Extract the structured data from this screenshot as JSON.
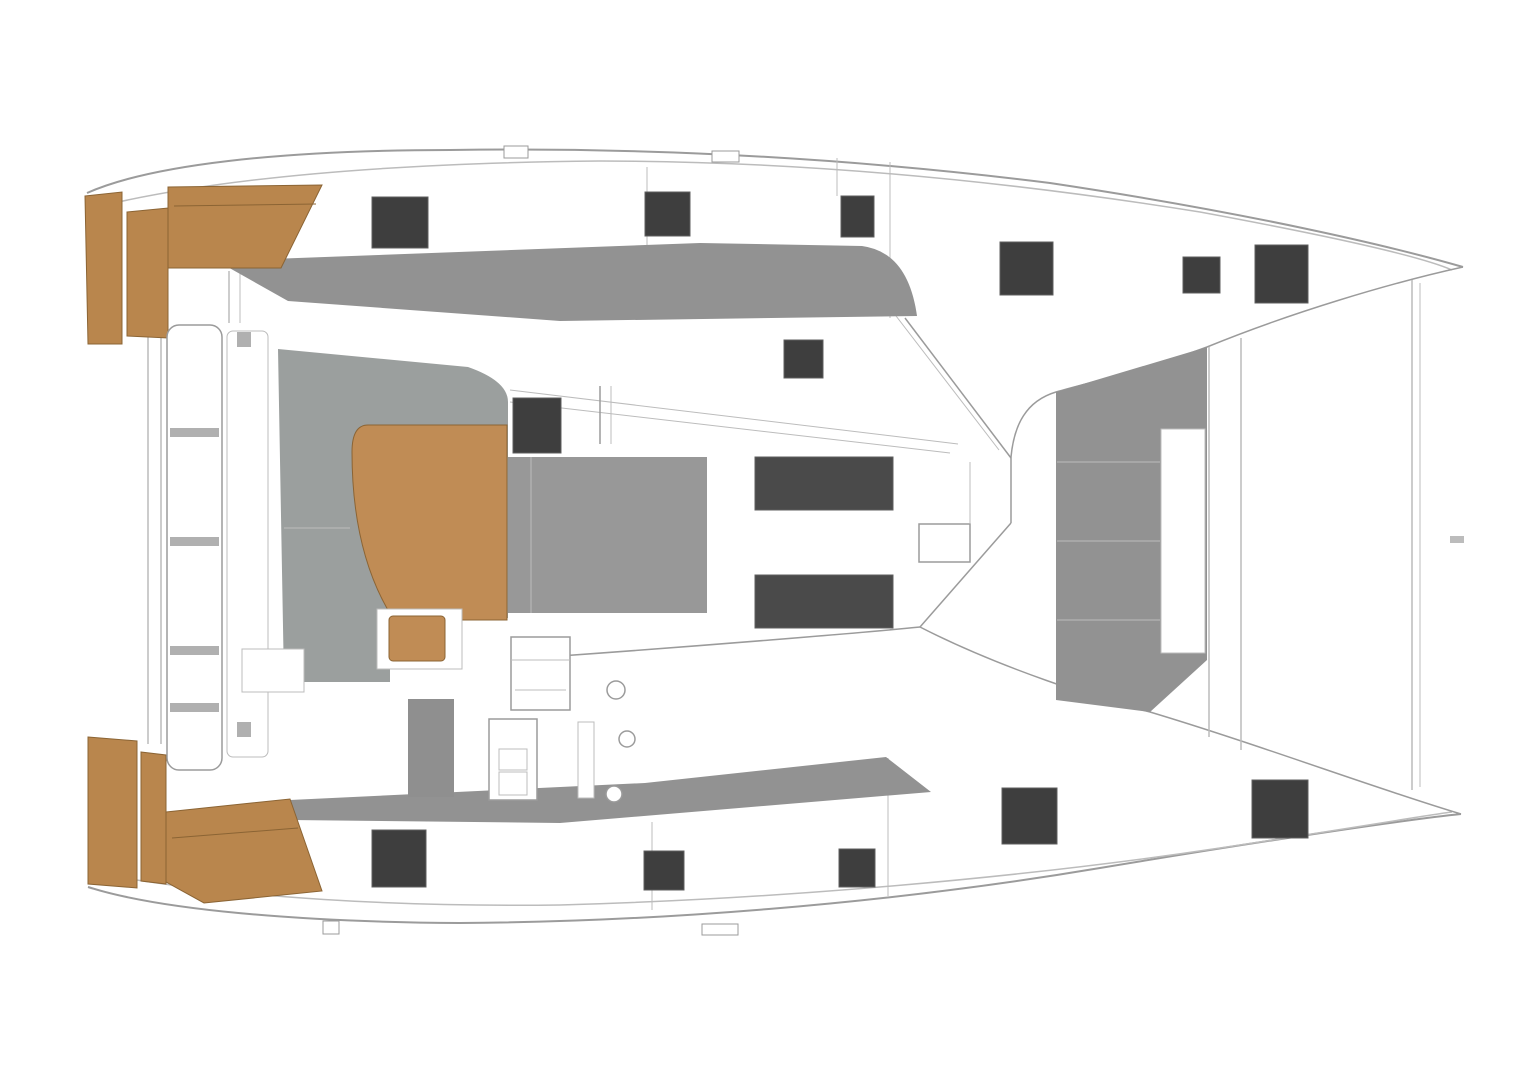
{
  "canvas": {
    "width": 1514,
    "height": 1080
  },
  "colors": {
    "bg": "#ffffff",
    "white": "#ffffff",
    "line": "#9b9b9b",
    "lineLight": "#bcbcbc",
    "deckGray": "#929292",
    "cockpitGray": "#9b9f9e",
    "sunpadGray": "#989898",
    "seatGray": "#8f8f8f",
    "dividerGray": "#b0b0b0",
    "hatchDark": "#3e3e3e",
    "hatchEdge": "#5f5f5f",
    "windowDark": "#4a4a4a",
    "wood": "#b9864d",
    "tableWood": "#c08c55",
    "woodEdge": "#8b6434"
  },
  "shapes": [
    {
      "name": "port-hull-outer-sheer-line",
      "type": "path",
      "d": "M87,193 C150,165 280,150 450,150 C650,147 850,158 1050,183 C1250,213 1390,246 1463,267",
      "fill": "none",
      "stroke": "line",
      "sw": 2
    },
    {
      "name": "port-hull-inner-sheer-line",
      "type": "path",
      "d": "M105,205 C230,176 400,163 600,161 C800,161 1000,180 1200,212 C1330,236 1420,256 1452,270",
      "fill": "none",
      "stroke": "lineLight",
      "sw": 1.5
    },
    {
      "name": "starboard-hull-outer-sheer-line",
      "type": "path",
      "d": "M88,887 C160,910 300,922 460,923 C650,922 880,905 1100,868 C1280,838 1420,818 1461,814",
      "fill": "none",
      "stroke": "line",
      "sw": 2
    },
    {
      "name": "starboard-hull-inner-sheer-line",
      "type": "path",
      "d": "M112,876 C240,898 400,907 560,905 C780,899 1020,878 1220,848 C1360,827 1440,813 1452,812",
      "fill": "none",
      "stroke": "lineLight",
      "sw": 1.5
    },
    {
      "name": "port-hull-inboard-edge-line",
      "type": "path",
      "d": "M1463,267 C1390,283 1290,313 1207,347 C1140,372 1090,382 1056,392 C1026,401 1014,425 1011,457",
      "fill": "none",
      "stroke": "line",
      "sw": 1.5
    },
    {
      "name": "starboard-walkway-edge-line",
      "type": "path",
      "d": "M920,627 C1000,668 1100,700 1150,712 C1260,745 1380,790 1461,814",
      "fill": "none",
      "stroke": "line",
      "sw": 1.5
    },
    {
      "name": "stern-center-line-left",
      "type": "path",
      "d": "M148,333 L148,744",
      "fill": "none",
      "stroke": "lineLight",
      "sw": 1.5
    },
    {
      "name": "stern-center-line-right",
      "type": "path",
      "d": "M161,333 L161,744",
      "fill": "none",
      "stroke": "lineLight",
      "sw": 1.5
    },
    {
      "name": "port-deck-frame-line-1",
      "type": "path",
      "d": "M647,167 L647,245",
      "fill": "none",
      "stroke": "lineLight",
      "sw": 1
    },
    {
      "name": "port-deck-frame-line-2",
      "type": "path",
      "d": "M890,162 L890,318",
      "fill": "none",
      "stroke": "lineLight",
      "sw": 1
    },
    {
      "name": "port-deck-frame-line-3",
      "type": "path",
      "d": "M837,158 L837,196",
      "fill": "none",
      "stroke": "lineLight",
      "sw": 1
    },
    {
      "name": "starboard-deck-frame-line-1",
      "type": "path",
      "d": "M652,822 L652,910",
      "fill": "none",
      "stroke": "lineLight",
      "sw": 1
    },
    {
      "name": "starboard-deck-frame-line-2",
      "type": "path",
      "d": "M888,758 L888,896",
      "fill": "none",
      "stroke": "lineLight",
      "sw": 1
    },
    {
      "name": "foredeck-beam-line-1",
      "type": "path",
      "d": "M1209,347 L1209,737",
      "fill": "none",
      "stroke": "lineLight",
      "sw": 1.5
    },
    {
      "name": "foredeck-beam-line-2",
      "type": "path",
      "d": "M1241,338 L1241,750",
      "fill": "none",
      "stroke": "lineLight",
      "sw": 1.5
    },
    {
      "name": "bow-bridle-line-1",
      "type": "path",
      "d": "M1412,280 L1412,790",
      "fill": "none",
      "stroke": "lineLight",
      "sw": 1.5
    },
    {
      "name": "bow-bridle-line-2",
      "type": "path",
      "d": "M1420,283 L1420,787",
      "fill": "none",
      "stroke": "lineLight",
      "sw": 1
    },
    {
      "name": "windshield-top-edge-line",
      "type": "path",
      "d": "M905,318 L1011,458",
      "fill": "none",
      "stroke": "line",
      "sw": 1.5
    },
    {
      "name": "windshield-top-edge-line-2",
      "type": "path",
      "d": "M893,312 L999,450",
      "fill": "none",
      "stroke": "lineLight",
      "sw": 1
    },
    {
      "name": "windshield-mullion-line",
      "type": "path",
      "d": "M1011,457 L1011,523",
      "fill": "none",
      "stroke": "line",
      "sw": 1.5
    },
    {
      "name": "windshield-mullion-line-2",
      "type": "path",
      "d": "M970,462 L970,523",
      "fill": "none",
      "stroke": "lineLight",
      "sw": 1
    },
    {
      "name": "windshield-bottom-edge-line",
      "type": "path",
      "d": "M1011,523 L920,627",
      "fill": "none",
      "stroke": "line",
      "sw": 1.5
    },
    {
      "name": "coachroof-bottom-edge-line",
      "type": "path",
      "d": "M560,656 C700,646 860,633 920,627",
      "fill": "none",
      "stroke": "line",
      "sw": 1.5
    },
    {
      "name": "coachroof-diagonal-line-1",
      "type": "path",
      "d": "M510,390 L958,444",
      "fill": "none",
      "stroke": "lineLight",
      "sw": 1
    },
    {
      "name": "coachroof-diagonal-line-2",
      "type": "path",
      "d": "M510,402 L950,453",
      "fill": "none",
      "stroke": "lineLight",
      "sw": 1
    },
    {
      "name": "mast-support-line-1",
      "type": "path",
      "d": "M600,386 L600,444",
      "fill": "none",
      "stroke": "line",
      "sw": 1.5
    },
    {
      "name": "mast-support-line-2",
      "type": "path",
      "d": "M611,386 L611,444",
      "fill": "none",
      "stroke": "lineLight",
      "sw": 1
    },
    {
      "name": "port-transom-step-line-1",
      "type": "path",
      "d": "M229,271 L229,323",
      "fill": "none",
      "stroke": "lineLight",
      "sw": 1.5
    },
    {
      "name": "port-transom-step-line-2",
      "type": "path",
      "d": "M240,272 L240,323",
      "fill": "none",
      "stroke": "lineLight",
      "sw": 1
    },
    {
      "name": "side-deck-nonskid-port",
      "type": "path",
      "d": "M217,261 L700,243 L862,246 Q908,252 917,316 L560,321 L288,301 Z",
      "fill": "deckGray",
      "stroke": "none",
      "sw": 0
    },
    {
      "name": "side-deck-nonskid-starboard",
      "type": "path",
      "d": "M290,800 L645,783 L886,757 L931,792 L560,823 L290,820 Z",
      "fill": "deckGray",
      "stroke": "none",
      "sw": 0
    },
    {
      "name": "cockpit-floor-area",
      "type": "path",
      "d": "M278,349 L468,367 Q508,381 508,402 L508,618 L447,618 L447,662 L390,662 L390,682 L284,682 Z",
      "fill": "cockpitGray",
      "stroke": "none",
      "sw": 0
    },
    {
      "name": "coachroof-sunpad-area",
      "type": "rect",
      "x": 508,
      "y": 457,
      "w": 199,
      "h": 156,
      "fill": "sunpadGray",
      "stroke": "none",
      "sw": 0
    },
    {
      "name": "sunpad-divider-line",
      "type": "path",
      "d": "M531,457 L531,613",
      "fill": "none",
      "stroke": "lineLight",
      "sw": 1
    },
    {
      "name": "cockpit-seat-edge-line",
      "type": "path",
      "d": "M284,528 L350,528",
      "fill": "none",
      "stroke": "lineLight",
      "sw": 1
    },
    {
      "name": "foredeck-lounge-panel",
      "type": "path",
      "d": "M1056,392 L1207,347 L1207,660 L1150,712 L1056,700 Z",
      "fill": "deckGray",
      "stroke": "none",
      "sw": 0
    },
    {
      "name": "foredeck-panel-seam-line-1",
      "type": "path",
      "d": "M1057,462 L1160,462",
      "fill": "none",
      "stroke": "lineLight",
      "sw": 1
    },
    {
      "name": "foredeck-panel-seam-line-2",
      "type": "path",
      "d": "M1057,541 L1160,541",
      "fill": "none",
      "stroke": "lineLight",
      "sw": 1
    },
    {
      "name": "foredeck-panel-seam-line-3",
      "type": "path",
      "d": "M1057,620 L1160,620",
      "fill": "none",
      "stroke": "lineLight",
      "sw": 1
    },
    {
      "name": "foredeck-panel-inset",
      "type": "rect",
      "x": 1161,
      "y": 429,
      "w": 44,
      "h": 224,
      "fill": "white",
      "stroke": "lineLight",
      "sw": 1
    },
    {
      "name": "helm-seat",
      "type": "rect",
      "x": 408,
      "y": 699,
      "w": 46,
      "h": 98,
      "fill": "seatGray",
      "stroke": "none",
      "sw": 0
    },
    {
      "name": "port-swim-platform-step",
      "type": "path",
      "d": "M85,196 L122,192 L122,344 L88,344 Z",
      "fill": "wood",
      "stroke": "woodEdge",
      "sw": 1
    },
    {
      "name": "port-swim-platform-step-2",
      "type": "path",
      "d": "M127,212 L168,208 L168,338 L127,336 Z",
      "fill": "wood",
      "stroke": "woodEdge",
      "sw": 1
    },
    {
      "name": "port-swim-platform-deck",
      "type": "path",
      "d": "M168,187 L322,185 L281,268 L168,268 Z",
      "fill": "wood",
      "stroke": "woodEdge",
      "sw": 1
    },
    {
      "name": "port-platform-plank-line",
      "type": "path",
      "d": "M174,206 L316,204",
      "fill": "none",
      "stroke": "woodEdge",
      "sw": 1
    },
    {
      "name": "starboard-swim-platform-step",
      "type": "path",
      "d": "M88,737 L137,741 L137,888 L88,884 Z",
      "fill": "wood",
      "stroke": "woodEdge",
      "sw": 1
    },
    {
      "name": "starboard-swim-platform-step-2",
      "type": "path",
      "d": "M141,752 L166,755 L166,884 L141,881 Z",
      "fill": "wood",
      "stroke": "woodEdge",
      "sw": 1
    },
    {
      "name": "starboard-swim-platform-deck",
      "type": "path",
      "d": "M166,812 L290,799 L322,891 L204,903 L166,882 Z",
      "fill": "wood",
      "stroke": "woodEdge",
      "sw": 1
    },
    {
      "name": "starboard-platform-plank-line",
      "type": "path",
      "d": "M172,838 L298,828",
      "fill": "none",
      "stroke": "woodEdge",
      "sw": 1
    },
    {
      "name": "cockpit-table",
      "type": "path",
      "d": "M368,425 L507,425 L507,620 L394,620 Q352,555 352,452 Q352,425 368,425 Z",
      "fill": "tableWood",
      "stroke": "woodEdge",
      "sw": 1
    },
    {
      "name": "aft-cockpit-bench",
      "type": "rect",
      "x": 167,
      "y": 325,
      "w": 55,
      "h": 445,
      "rx": 12,
      "fill": "white",
      "stroke": "line",
      "sw": 1.5
    },
    {
      "name": "aft-cockpit-bench-backrest",
      "type": "rect",
      "x": 227,
      "y": 331,
      "w": 41,
      "h": 426,
      "rx": 6,
      "fill": "white",
      "stroke": "lineLight",
      "sw": 1
    },
    {
      "name": "bench-divider-1",
      "type": "rect",
      "x": 170,
      "y": 428,
      "w": 49,
      "h": 9,
      "fill": "dividerGray",
      "stroke": "none",
      "sw": 0
    },
    {
      "name": "bench-divider-2",
      "type": "rect",
      "x": 170,
      "y": 537,
      "w": 49,
      "h": 9,
      "fill": "dividerGray",
      "stroke": "none",
      "sw": 0
    },
    {
      "name": "bench-divider-3",
      "type": "rect",
      "x": 170,
      "y": 646,
      "w": 49,
      "h": 9,
      "fill": "dividerGray",
      "stroke": "none",
      "sw": 0
    },
    {
      "name": "bench-divider-4",
      "type": "rect",
      "x": 170,
      "y": 703,
      "w": 49,
      "h": 9,
      "fill": "dividerGray",
      "stroke": "none",
      "sw": 0
    },
    {
      "name": "backrest-fitting-top",
      "type": "rect",
      "x": 237,
      "y": 332,
      "w": 14,
      "h": 15,
      "fill": "dividerGray",
      "stroke": "none",
      "sw": 0
    },
    {
      "name": "backrest-fitting-bottom",
      "type": "rect",
      "x": 237,
      "y": 722,
      "w": 14,
      "h": 15,
      "fill": "dividerGray",
      "stroke": "none",
      "sw": 0
    },
    {
      "name": "cockpit-storage-box",
      "type": "rect",
      "x": 242,
      "y": 649,
      "w": 62,
      "h": 43,
      "fill": "white",
      "stroke": "lineLight",
      "sw": 1
    },
    {
      "name": "helm-stool-frame",
      "type": "rect",
      "x": 377,
      "y": 609,
      "w": 85,
      "h": 60,
      "fill": "white",
      "stroke": "lineLight",
      "sw": 1
    },
    {
      "name": "helm-stool-cushion",
      "type": "rect",
      "x": 389,
      "y": 616,
      "w": 56,
      "h": 45,
      "rx": 4,
      "fill": "tableWood",
      "stroke": "woodEdge",
      "sw": 1
    },
    {
      "name": "helm-module",
      "type": "rect",
      "x": 511,
      "y": 637,
      "w": 59,
      "h": 73,
      "fill": "white",
      "stroke": "line",
      "sw": 1.5
    },
    {
      "name": "helm-module-shelf-line",
      "type": "path",
      "d": "M511,660 L570,660",
      "fill": "none",
      "stroke": "lineLight",
      "sw": 1
    },
    {
      "name": "helm-module-shelf-line-2",
      "type": "path",
      "d": "M515,690 L566,690",
      "fill": "none",
      "stroke": "lineLight",
      "sw": 1
    },
    {
      "name": "helm-console",
      "type": "rect",
      "x": 489,
      "y": 719,
      "w": 48,
      "h": 81,
      "fill": "white",
      "stroke": "line",
      "sw": 1.5
    },
    {
      "name": "helm-console-panel-1",
      "type": "rect",
      "x": 499,
      "y": 749,
      "w": 28,
      "h": 21,
      "fill": "none",
      "stroke": "lineLight",
      "sw": 1
    },
    {
      "name": "helm-console-panel-2",
      "type": "rect",
      "x": 499,
      "y": 772,
      "w": 28,
      "h": 23,
      "fill": "none",
      "stroke": "lineLight",
      "sw": 1
    },
    {
      "name": "helm-side-locker",
      "type": "rect",
      "x": 578,
      "y": 722,
      "w": 16,
      "h": 76,
      "fill": "white",
      "stroke": "lineLight",
      "sw": 1
    },
    {
      "name": "winch-1",
      "type": "circle",
      "cx": 616,
      "cy": 690,
      "r": 9,
      "fill": "white",
      "stroke": "line",
      "sw": 1.5
    },
    {
      "name": "winch-2",
      "type": "circle",
      "cx": 627,
      "cy": 739,
      "r": 8,
      "fill": "white",
      "stroke": "line",
      "sw": 1.5
    },
    {
      "name": "winch-3",
      "type": "circle",
      "cx": 614,
      "cy": 794,
      "r": 8,
      "fill": "white",
      "stroke": "line",
      "sw": 1.5
    },
    {
      "name": "walkway-locker-box",
      "type": "rect",
      "x": 919,
      "y": 524,
      "w": 51,
      "h": 38,
      "fill": "white",
      "stroke": "line",
      "sw": 1.5
    },
    {
      "name": "port-rail-fitting",
      "type": "rect",
      "x": 504,
      "y": 146,
      "w": 24,
      "h": 12,
      "fill": "white",
      "stroke": "line",
      "sw": 1
    },
    {
      "name": "port-rail-fitting-2",
      "type": "rect",
      "x": 712,
      "y": 151,
      "w": 27,
      "h": 11,
      "fill": "white",
      "stroke": "line",
      "sw": 1
    },
    {
      "name": "starboard-rail-fitting",
      "type": "rect",
      "x": 702,
      "y": 924,
      "w": 36,
      "h": 11,
      "fill": "white",
      "stroke": "line",
      "sw": 1
    },
    {
      "name": "starboard-rail-fitting-2",
      "type": "rect",
      "x": 323,
      "y": 921,
      "w": 16,
      "h": 13,
      "fill": "white",
      "stroke": "line",
      "sw": 1
    },
    {
      "name": "centerline-tick",
      "type": "rect",
      "x": 1450,
      "y": 536,
      "w": 14,
      "h": 7,
      "fill": "lineLight",
      "stroke": "none",
      "sw": 0
    },
    {
      "name": "deck-hatch-port-aft",
      "type": "rect",
      "x": 372,
      "y": 197,
      "w": 56,
      "h": 51,
      "fill": "hatchDark",
      "stroke": "hatchEdge",
      "sw": 1
    },
    {
      "name": "deck-hatch-port-mid-1",
      "type": "rect",
      "x": 645,
      "y": 192,
      "w": 45,
      "h": 44,
      "fill": "hatchDark",
      "stroke": "hatchEdge",
      "sw": 1
    },
    {
      "name": "deck-hatch-port-mid-2",
      "type": "rect",
      "x": 841,
      "y": 196,
      "w": 33,
      "h": 41,
      "fill": "hatchDark",
      "stroke": "hatchEdge",
      "sw": 1
    },
    {
      "name": "deck-hatch-port-fwd-1",
      "type": "rect",
      "x": 1000,
      "y": 242,
      "w": 53,
      "h": 53,
      "fill": "hatchDark",
      "stroke": "hatchEdge",
      "sw": 1
    },
    {
      "name": "deck-hatch-port-fwd-small",
      "type": "rect",
      "x": 1183,
      "y": 257,
      "w": 37,
      "h": 36,
      "fill": "hatchDark",
      "stroke": "hatchEdge",
      "sw": 1
    },
    {
      "name": "deck-hatch-port-bow",
      "type": "rect",
      "x": 1255,
      "y": 245,
      "w": 53,
      "h": 58,
      "fill": "hatchDark",
      "stroke": "hatchEdge",
      "sw": 1
    },
    {
      "name": "coachroof-hatch-small",
      "type": "rect",
      "x": 784,
      "y": 340,
      "w": 39,
      "h": 38,
      "fill": "hatchDark",
      "stroke": "hatchEdge",
      "sw": 1
    },
    {
      "name": "coachroof-hatch-mast",
      "type": "rect",
      "x": 513,
      "y": 398,
      "w": 48,
      "h": 55,
      "fill": "hatchDark",
      "stroke": "hatchEdge",
      "sw": 1
    },
    {
      "name": "coachroof-window-1",
      "type": "rect",
      "x": 755,
      "y": 457,
      "w": 138,
      "h": 53,
      "fill": "windowDark",
      "stroke": "hatchEdge",
      "sw": 1
    },
    {
      "name": "coachroof-window-2",
      "type": "rect",
      "x": 755,
      "y": 575,
      "w": 138,
      "h": 53,
      "fill": "windowDark",
      "stroke": "hatchEdge",
      "sw": 1
    },
    {
      "name": "deck-hatch-stbd-aft",
      "type": "rect",
      "x": 372,
      "y": 830,
      "w": 54,
      "h": 57,
      "fill": "hatchDark",
      "stroke": "hatchEdge",
      "sw": 1
    },
    {
      "name": "deck-hatch-stbd-mid-1",
      "type": "rect",
      "x": 644,
      "y": 851,
      "w": 40,
      "h": 39,
      "fill": "hatchDark",
      "stroke": "hatchEdge",
      "sw": 1
    },
    {
      "name": "deck-hatch-stbd-mid-2",
      "type": "rect",
      "x": 839,
      "y": 849,
      "w": 36,
      "h": 38,
      "fill": "hatchDark",
      "stroke": "hatchEdge",
      "sw": 1
    },
    {
      "name": "deck-hatch-stbd-fwd",
      "type": "rect",
      "x": 1002,
      "y": 788,
      "w": 55,
      "h": 56,
      "fill": "hatchDark",
      "stroke": "hatchEdge",
      "sw": 1
    },
    {
      "name": "deck-hatch-stbd-bow",
      "type": "rect",
      "x": 1252,
      "y": 780,
      "w": 56,
      "h": 58,
      "fill": "hatchDark",
      "stroke": "hatchEdge",
      "sw": 1
    }
  ]
}
